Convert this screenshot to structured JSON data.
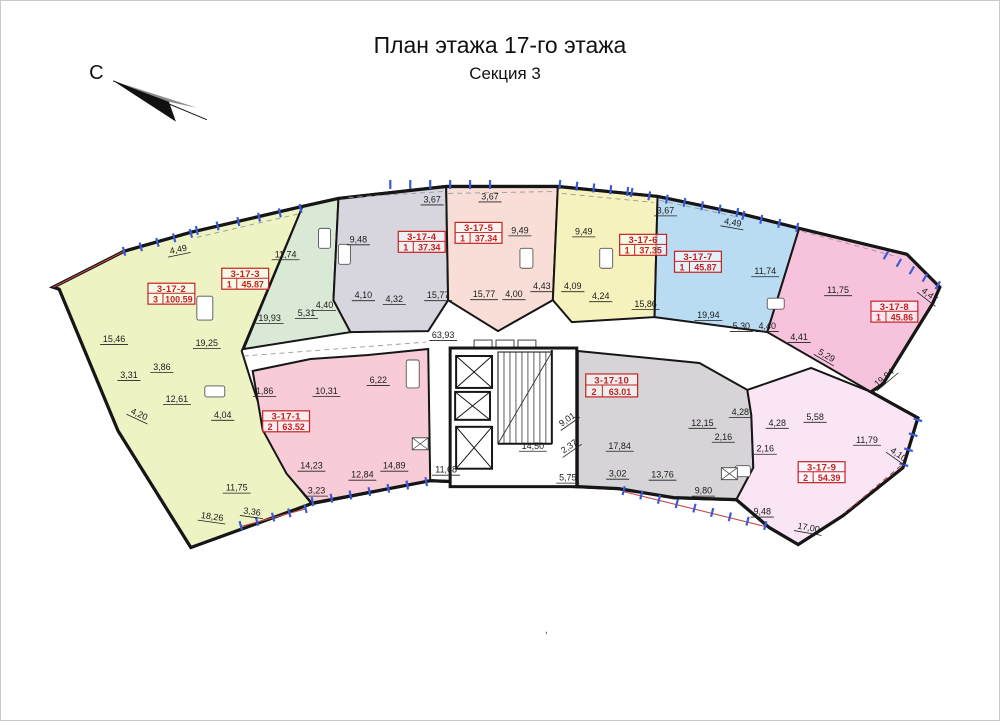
{
  "title": "План этажа 17-го этажа",
  "subtitle": "Секция 3",
  "compass": {
    "label": "С"
  },
  "stray_mark": ",",
  "colors": {
    "wall": "#161616",
    "label_red": "#c32222",
    "accent_red": "#c04848",
    "window_tick": "#3b5bd6",
    "background": "#ffffff"
  },
  "building": {
    "outline": [
      [
        52,
        287
      ],
      [
        123,
        251
      ],
      [
        190,
        232
      ],
      [
        302,
        206
      ],
      [
        338,
        198
      ],
      [
        446,
        186
      ],
      [
        558,
        186
      ],
      [
        658,
        196
      ],
      [
        740,
        213
      ],
      [
        800,
        228
      ],
      [
        908,
        254
      ],
      [
        941,
        287
      ],
      [
        934,
        303
      ],
      [
        884,
        384
      ],
      [
        872,
        392
      ],
      [
        919,
        418
      ],
      [
        904,
        468
      ],
      [
        844,
        516
      ],
      [
        799,
        545
      ],
      [
        770,
        528
      ],
      [
        737,
        500
      ],
      [
        674,
        498
      ],
      [
        619,
        489
      ],
      [
        578,
        487
      ],
      [
        430,
        481
      ],
      [
        311,
        504
      ],
      [
        190,
        548
      ],
      [
        117,
        431
      ],
      [
        58,
        289
      ]
    ]
  },
  "apartments": [
    {
      "id": "3-17-2",
      "rooms": "3",
      "area": "100.59",
      "color": "#eef3c4",
      "label": [
        147,
        283,
        47,
        21
      ],
      "polygon": [
        [
          52,
          287
        ],
        [
          123,
          251
        ],
        [
          190,
          232
        ],
        [
          302,
          206
        ],
        [
          241,
          351
        ],
        [
          250,
          380
        ],
        [
          270,
          440
        ],
        [
          288,
          476
        ],
        [
          311,
          504
        ],
        [
          190,
          548
        ],
        [
          117,
          431
        ],
        [
          58,
          289
        ]
      ]
    },
    {
      "id": "3-17-3",
      "rooms": "1",
      "area": "45.87",
      "color": "#d9e9d5",
      "label": [
        221,
        268,
        47,
        21
      ],
      "polygon": [
        [
          302,
          206
        ],
        [
          338,
          198
        ],
        [
          333,
          300
        ],
        [
          350,
          332
        ],
        [
          243,
          349
        ]
      ]
    },
    {
      "id": "3-17-4",
      "rooms": "1",
      "area": "37.34",
      "color": "#d7d5dd",
      "label": [
        398,
        231,
        47,
        21
      ],
      "polygon": [
        [
          338,
          198
        ],
        [
          446,
          186
        ],
        [
          448,
          300
        ],
        [
          428,
          331
        ],
        [
          350,
          332
        ],
        [
          333,
          300
        ]
      ]
    },
    {
      "id": "3-17-5",
      "rooms": "1",
      "area": "37.34",
      "color": "#f8ded7",
      "label": [
        455,
        222,
        47,
        21
      ],
      "polygon": [
        [
          446,
          186
        ],
        [
          558,
          186
        ],
        [
          553,
          300
        ],
        [
          498,
          331
        ],
        [
          448,
          300
        ]
      ]
    },
    {
      "id": "3-17-6",
      "rooms": "1",
      "area": "37.35",
      "color": "#f6f2bd",
      "label": [
        620,
        234,
        47,
        21
      ],
      "polygon": [
        [
          558,
          186
        ],
        [
          658,
          196
        ],
        [
          655,
          317
        ],
        [
          572,
          322
        ],
        [
          553,
          300
        ]
      ]
    },
    {
      "id": "3-17-7",
      "rooms": "1",
      "area": "45.87",
      "color": "#badcf3",
      "label": [
        675,
        251,
        47,
        21
      ],
      "polygon": [
        [
          658,
          196
        ],
        [
          740,
          213
        ],
        [
          800,
          228
        ],
        [
          768,
          332
        ],
        [
          655,
          317
        ]
      ]
    },
    {
      "id": "3-17-8",
      "rooms": "1",
      "area": "45.86",
      "color": "#f7c2dc",
      "label": [
        872,
        301,
        47,
        21
      ],
      "polygon": [
        [
          800,
          228
        ],
        [
          908,
          254
        ],
        [
          941,
          287
        ],
        [
          934,
          303
        ],
        [
          884,
          384
        ],
        [
          872,
          392
        ],
        [
          768,
          332
        ]
      ]
    },
    {
      "id": "3-17-1",
      "rooms": "2",
      "area": "63.52",
      "color": "#f8ccd6",
      "label": [
        262,
        411,
        47,
        21
      ],
      "polygon": [
        [
          252,
          371
        ],
        [
          310,
          359
        ],
        [
          368,
          355
        ],
        [
          428,
          349
        ],
        [
          430,
          481
        ],
        [
          311,
          503
        ],
        [
          286,
          474
        ],
        [
          262,
          430
        ]
      ]
    },
    {
      "id": "3-17-10",
      "rooms": "2",
      "area": "63.01",
      "color": "#d6d4d6",
      "label": [
        586,
        374,
        52,
        23
      ],
      "polygon": [
        [
          578,
          351
        ],
        [
          700,
          363
        ],
        [
          748,
          390
        ],
        [
          752,
          415
        ],
        [
          754,
          468
        ],
        [
          737,
          500
        ],
        [
          674,
          498
        ],
        [
          619,
          489
        ],
        [
          578,
          487
        ]
      ]
    },
    {
      "id": "3-17-9",
      "rooms": "2",
      "area": "54.39",
      "color": "#f9e5f4",
      "label": [
        799,
        462,
        47,
        21
      ],
      "polygon": [
        [
          752,
          415
        ],
        [
          748,
          390
        ],
        [
          812,
          368
        ],
        [
          872,
          392
        ],
        [
          919,
          418
        ],
        [
          904,
          468
        ],
        [
          844,
          516
        ],
        [
          799,
          545
        ],
        [
          770,
          528
        ],
        [
          737,
          500
        ],
        [
          754,
          468
        ]
      ]
    }
  ],
  "core": {
    "outline": [
      450,
      348,
      127,
      139
    ],
    "elevators": [
      [
        456,
        356,
        36,
        32
      ],
      [
        455,
        392,
        35,
        28
      ],
      [
        456,
        427,
        36,
        42
      ]
    ],
    "stair": {
      "x": 498,
      "y": 352,
      "w": 54,
      "h": 92,
      "treads": 9
    },
    "machines": [
      [
        474,
        340,
        18,
        9
      ],
      [
        496,
        340,
        18,
        9
      ],
      [
        518,
        340,
        18,
        9
      ]
    ],
    "inner_walls": [
      [
        498,
        444,
        552,
        444
      ],
      [
        552,
        350,
        552,
        444
      ]
    ]
  },
  "fixtures": [
    [
      196,
      296,
      16,
      24
    ],
    [
      204,
      386,
      20,
      11
    ],
    [
      318,
      228,
      12,
      20
    ],
    [
      338,
      244,
      12,
      20
    ],
    [
      406,
      360,
      13,
      28
    ],
    [
      520,
      248,
      13,
      20
    ],
    [
      600,
      248,
      13,
      20
    ],
    [
      768,
      298,
      17,
      11
    ],
    [
      736,
      466,
      15,
      11
    ]
  ],
  "shafts": [
    [
      412,
      438,
      16,
      12
    ],
    [
      722,
      468,
      16,
      12
    ]
  ],
  "dashed_gray": [
    [
      243,
      356,
      426,
      342
    ],
    [
      196,
      237,
      300,
      213
    ],
    [
      348,
      197,
      444,
      191
    ],
    [
      448,
      193,
      556,
      191
    ],
    [
      562,
      193,
      654,
      202
    ],
    [
      660,
      200,
      736,
      216
    ],
    [
      803,
      231,
      900,
      257
    ]
  ],
  "red_lines": [
    [
      52,
      287,
      123,
      251,
      0
    ],
    [
      240,
      527,
      306,
      509,
      0
    ],
    [
      624,
      492,
      766,
      527,
      0
    ],
    [
      902,
      466,
      846,
      513,
      1
    ]
  ],
  "window_ticks": [
    [
      123,
      251,
      190,
      233,
      4
    ],
    [
      196,
      230,
      300,
      208,
      5
    ],
    [
      390,
      184,
      490,
      184,
      5
    ],
    [
      560,
      184,
      628,
      191,
      4
    ],
    [
      632,
      192,
      738,
      212,
      6
    ],
    [
      744,
      215,
      798,
      227,
      3
    ],
    [
      887,
      255,
      939,
      285,
      4
    ],
    [
      919,
      420,
      905,
      465,
      3
    ],
    [
      240,
      526,
      305,
      509,
      4
    ],
    [
      312,
      502,
      426,
      482,
      6
    ],
    [
      624,
      491,
      766,
      526,
      8
    ]
  ],
  "dimensions": [
    [
      "4,49",
      178,
      252,
      -12
    ],
    [
      "11,74",
      285,
      257,
      0
    ],
    [
      "9,48",
      358,
      242,
      0
    ],
    [
      "3,67",
      432,
      202,
      0
    ],
    [
      "3,67",
      490,
      199,
      0
    ],
    [
      "9,49",
      520,
      233,
      0
    ],
    [
      "9,49",
      584,
      234,
      0
    ],
    [
      "3,67",
      666,
      213,
      0
    ],
    [
      "4,49",
      733,
      225,
      10
    ],
    [
      "11,74",
      766,
      274,
      0
    ],
    [
      "11,75",
      839,
      293,
      0
    ],
    [
      "4,47",
      929,
      297,
      38
    ],
    [
      "15,46",
      113,
      342,
      0
    ],
    [
      "19,25",
      206,
      346,
      0
    ],
    [
      "19,93",
      269,
      321,
      0
    ],
    [
      "5,31",
      306,
      316,
      0
    ],
    [
      "4,40",
      324,
      308,
      0
    ],
    [
      "4,10",
      363,
      298,
      0
    ],
    [
      "4,32",
      394,
      302,
      0
    ],
    [
      "15,77",
      438,
      298,
      0
    ],
    [
      "15,77",
      484,
      297,
      0
    ],
    [
      "4,00",
      514,
      297,
      0
    ],
    [
      "4,43",
      542,
      289,
      0
    ],
    [
      "4,09",
      573,
      289,
      0
    ],
    [
      "4,24",
      601,
      299,
      0
    ],
    [
      "15,86",
      646,
      307,
      0
    ],
    [
      "19,94",
      709,
      318,
      0
    ],
    [
      "5,30",
      742,
      329,
      0
    ],
    [
      "4,40",
      768,
      329,
      0
    ],
    [
      "4,41",
      800,
      340,
      0
    ],
    [
      "5,29",
      826,
      358,
      30
    ],
    [
      "19,94",
      887,
      380,
      -40
    ],
    [
      "3,31",
      128,
      378,
      0
    ],
    [
      "3,86",
      161,
      370,
      0
    ],
    [
      "12,61",
      176,
      402,
      0
    ],
    [
      "4,20",
      137,
      417,
      25
    ],
    [
      "4,04",
      222,
      418,
      0
    ],
    [
      "1,86",
      264,
      394,
      0
    ],
    [
      "10,31",
      326,
      394,
      0
    ],
    [
      "6,22",
      378,
      383,
      0
    ],
    [
      "14,23",
      311,
      469,
      0
    ],
    [
      "3,23",
      316,
      494,
      0
    ],
    [
      "12,84",
      362,
      478,
      0
    ],
    [
      "14,89",
      394,
      469,
      0
    ],
    [
      "11,75",
      236,
      491,
      0
    ],
    [
      "3,36",
      251,
      515,
      8
    ],
    [
      "18,26",
      211,
      520,
      8
    ],
    [
      "63,93",
      443,
      338,
      0
    ],
    [
      "11,68",
      446,
      473,
      0
    ],
    [
      "14,50",
      533,
      449,
      0
    ],
    [
      "9,01",
      569,
      422,
      -35
    ],
    [
      "2,37",
      571,
      449,
      -35
    ],
    [
      "5,75",
      568,
      481,
      0
    ],
    [
      "17,84",
      620,
      449,
      0
    ],
    [
      "3,02",
      618,
      477,
      0
    ],
    [
      "13,76",
      663,
      478,
      0
    ],
    [
      "12,15",
      703,
      426,
      0
    ],
    [
      "2,16",
      724,
      440,
      0
    ],
    [
      "2,16",
      766,
      452,
      0
    ],
    [
      "4,28",
      741,
      415,
      0
    ],
    [
      "4,28",
      778,
      426,
      0
    ],
    [
      "9,80",
      704,
      494,
      0
    ],
    [
      "9,48",
      763,
      515,
      0
    ],
    [
      "5,58",
      816,
      420,
      0
    ],
    [
      "11,79",
      868,
      443,
      0
    ],
    [
      "4,10",
      898,
      457,
      35
    ],
    [
      "17,00",
      809,
      531,
      10
    ]
  ]
}
